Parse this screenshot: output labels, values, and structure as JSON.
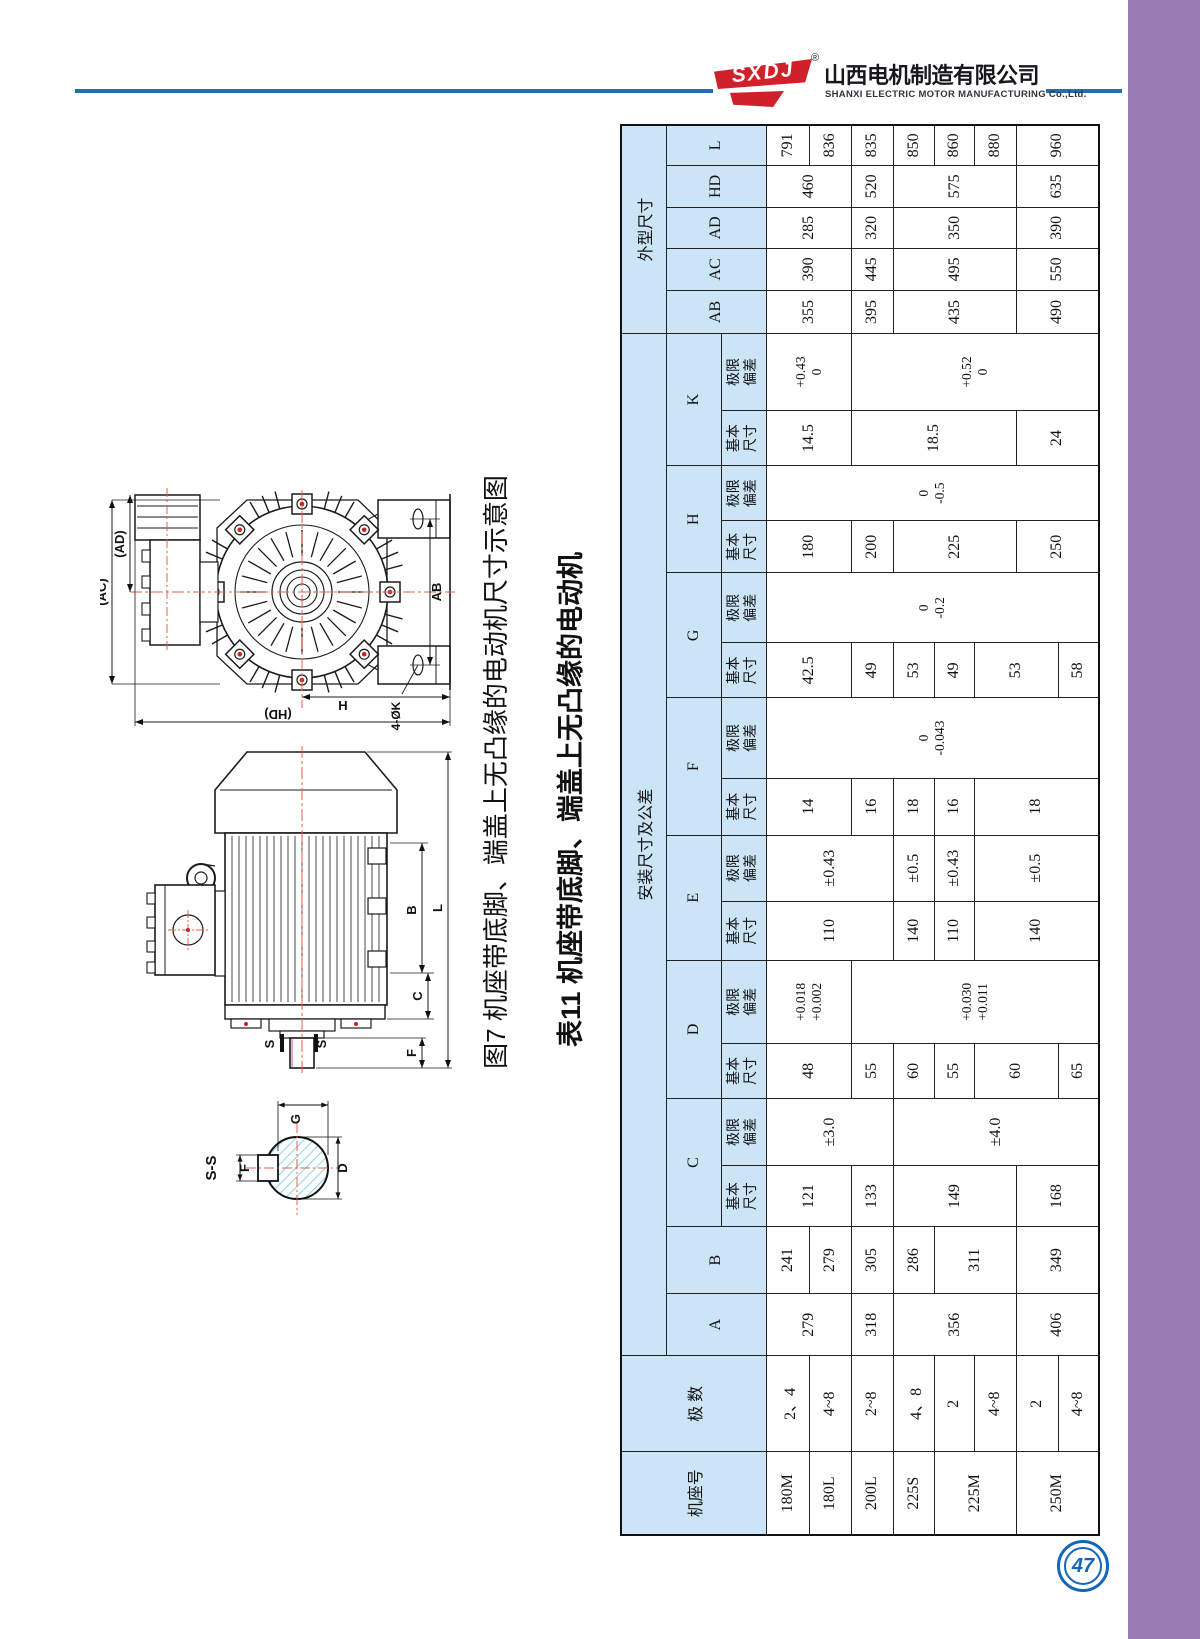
{
  "page": {
    "number": "47"
  },
  "header": {
    "logo_text": "SXDJ",
    "reg_mark": "®",
    "company_cn": "山西电机制造有限公司",
    "company_en": "SHANXI ELECTRIC MOTOR MANUFACTURING Co.,Ltd."
  },
  "figure": {
    "caption": "图7 机座带底脚、端盖上无凸缘的电动机尺寸示意图",
    "end_view_labels": {
      "ac": "(AC)",
      "ad": "(AD)",
      "ab": "AB",
      "h": "H",
      "hd": "(HD)",
      "k4": "4-ØK"
    },
    "side_view_labels": {
      "b": "B",
      "l": "L",
      "c": "C",
      "f": "F",
      "s1": "S",
      "s2": "S"
    },
    "section_labels": {
      "title": "S-S",
      "f": "F",
      "g": "G",
      "d": "D"
    }
  },
  "table": {
    "caption": "表11 机座带底脚、端盖上无凸缘的电动机",
    "cells": [
      [
        0,
        0,
        3,
        1,
        "机座号",
        1
      ],
      [
        0,
        1,
        3,
        1,
        "极 数",
        1
      ],
      [
        0,
        2,
        1,
        16,
        "安装尺寸及公差",
        1
      ],
      [
        0,
        18,
        1,
        5,
        "外型尺寸",
        1
      ],
      [
        1,
        2,
        2,
        1,
        "A",
        1
      ],
      [
        1,
        3,
        2,
        1,
        "B",
        1
      ],
      [
        1,
        4,
        1,
        2,
        "C",
        1
      ],
      [
        1,
        6,
        1,
        2,
        "D",
        1
      ],
      [
        1,
        8,
        1,
        2,
        "E",
        1
      ],
      [
        1,
        10,
        1,
        2,
        "F",
        1
      ],
      [
        1,
        12,
        1,
        2,
        "G",
        1
      ],
      [
        1,
        14,
        1,
        2,
        "H",
        1
      ],
      [
        1,
        16,
        1,
        2,
        "K",
        1
      ],
      [
        1,
        18,
        2,
        1,
        "AB",
        1
      ],
      [
        1,
        19,
        2,
        1,
        "AC",
        1
      ],
      [
        1,
        20,
        2,
        1,
        "AD",
        1
      ],
      [
        1,
        21,
        2,
        1,
        "HD",
        1
      ],
      [
        1,
        22,
        2,
        1,
        "L",
        1
      ],
      [
        2,
        4,
        1,
        1,
        "基本\n尺寸",
        1
      ],
      [
        2,
        5,
        1,
        1,
        "极限\n偏差",
        1
      ],
      [
        2,
        6,
        1,
        1,
        "基本\n尺寸",
        1
      ],
      [
        2,
        7,
        1,
        1,
        "极限\n偏差",
        1
      ],
      [
        2,
        8,
        1,
        1,
        "基本\n尺寸",
        1
      ],
      [
        2,
        9,
        1,
        1,
        "极限\n偏差",
        1
      ],
      [
        2,
        10,
        1,
        1,
        "基本\n尺寸",
        1
      ],
      [
        2,
        11,
        1,
        1,
        "极限\n偏差",
        1
      ],
      [
        2,
        12,
        1,
        1,
        "基本\n尺寸",
        1
      ],
      [
        2,
        13,
        1,
        1,
        "极限\n偏差",
        1
      ],
      [
        2,
        14,
        1,
        1,
        "基本\n尺寸",
        1
      ],
      [
        2,
        15,
        1,
        1,
        "极限\n偏差",
        1
      ],
      [
        2,
        16,
        1,
        1,
        "基本\n尺寸",
        1
      ],
      [
        2,
        17,
        1,
        1,
        "极限\n偏差",
        1
      ],
      [
        3,
        0,
        1,
        1,
        "180M",
        0
      ],
      [
        3,
        1,
        1,
        1,
        "2、4",
        0
      ],
      [
        3,
        2,
        2,
        1,
        "279",
        0
      ],
      [
        3,
        3,
        1,
        1,
        "241",
        0
      ],
      [
        3,
        4,
        2,
        1,
        "121",
        0
      ],
      [
        3,
        5,
        3,
        1,
        "±3.0",
        0
      ],
      [
        3,
        6,
        2,
        1,
        "48",
        0
      ],
      [
        3,
        7,
        2,
        1,
        "+0.018\n+0.002",
        0
      ],
      [
        3,
        8,
        3,
        1,
        "110",
        0
      ],
      [
        3,
        9,
        3,
        1,
        "±0.43",
        0
      ],
      [
        3,
        10,
        2,
        1,
        "14",
        0
      ],
      [
        3,
        11,
        8,
        1,
        "0\n-0.043",
        0
      ],
      [
        3,
        12,
        2,
        1,
        "42.5",
        0
      ],
      [
        3,
        13,
        8,
        1,
        "0\n-0.2",
        0
      ],
      [
        3,
        14,
        2,
        1,
        "180",
        0
      ],
      [
        3,
        15,
        8,
        1,
        "0\n-0.5",
        0
      ],
      [
        3,
        16,
        2,
        1,
        "14.5",
        0
      ],
      [
        3,
        17,
        2,
        1,
        "+0.43\n0",
        0
      ],
      [
        3,
        18,
        2,
        1,
        "355",
        0
      ],
      [
        3,
        19,
        2,
        1,
        "390",
        0
      ],
      [
        3,
        20,
        2,
        1,
        "285",
        0
      ],
      [
        3,
        21,
        2,
        1,
        "460",
        0
      ],
      [
        3,
        22,
        1,
        1,
        "791",
        0
      ],
      [
        4,
        0,
        1,
        1,
        "180L",
        0
      ],
      [
        4,
        1,
        1,
        1,
        "4~8",
        0
      ],
      [
        4,
        3,
        1,
        1,
        "279",
        0
      ],
      [
        4,
        22,
        1,
        1,
        "836",
        0
      ],
      [
        5,
        0,
        1,
        1,
        "200L",
        0
      ],
      [
        5,
        1,
        1,
        1,
        "2~8",
        0
      ],
      [
        5,
        2,
        1,
        1,
        "318",
        0
      ],
      [
        5,
        3,
        1,
        1,
        "305",
        0
      ],
      [
        5,
        4,
        1,
        1,
        "133",
        0
      ],
      [
        5,
        6,
        1,
        1,
        "55",
        0
      ],
      [
        5,
        7,
        6,
        1,
        "+0.030\n+0.011",
        0
      ],
      [
        5,
        10,
        1,
        1,
        "16",
        0
      ],
      [
        5,
        12,
        1,
        1,
        "49",
        0
      ],
      [
        5,
        14,
        1,
        1,
        "200",
        0
      ],
      [
        5,
        16,
        4,
        1,
        "18.5",
        0
      ],
      [
        5,
        17,
        6,
        1,
        "+0.52\n0",
        0
      ],
      [
        5,
        18,
        1,
        1,
        "395",
        0
      ],
      [
        5,
        19,
        1,
        1,
        "445",
        0
      ],
      [
        5,
        20,
        1,
        1,
        "320",
        0
      ],
      [
        5,
        21,
        1,
        1,
        "520",
        0
      ],
      [
        5,
        22,
        1,
        1,
        "835",
        0
      ],
      [
        6,
        0,
        1,
        1,
        "225S",
        0
      ],
      [
        6,
        1,
        1,
        1,
        "4、8",
        0
      ],
      [
        6,
        2,
        3,
        1,
        "356",
        0
      ],
      [
        6,
        3,
        1,
        1,
        "286",
        0
      ],
      [
        6,
        4,
        3,
        1,
        "149",
        0
      ],
      [
        6,
        5,
        5,
        1,
        "±4.0",
        0
      ],
      [
        6,
        6,
        1,
        1,
        "60",
        0
      ],
      [
        6,
        8,
        1,
        1,
        "140",
        0
      ],
      [
        6,
        9,
        1,
        1,
        "±0.5",
        0
      ],
      [
        6,
        10,
        1,
        1,
        "18",
        0
      ],
      [
        6,
        12,
        1,
        1,
        "53",
        0
      ],
      [
        6,
        14,
        3,
        1,
        "225",
        0
      ],
      [
        6,
        18,
        3,
        1,
        "435",
        0
      ],
      [
        6,
        19,
        3,
        1,
        "495",
        0
      ],
      [
        6,
        20,
        3,
        1,
        "350",
        0
      ],
      [
        6,
        21,
        3,
        1,
        "575",
        0
      ],
      [
        6,
        22,
        1,
        1,
        "850",
        0
      ],
      [
        7,
        0,
        2,
        1,
        "225M",
        0
      ],
      [
        7,
        1,
        1,
        1,
        "2",
        0
      ],
      [
        7,
        3,
        2,
        1,
        "311",
        0
      ],
      [
        7,
        6,
        1,
        1,
        "55",
        0
      ],
      [
        7,
        8,
        1,
        1,
        "110",
        0
      ],
      [
        7,
        9,
        1,
        1,
        "±0.43",
        0
      ],
      [
        7,
        10,
        1,
        1,
        "16",
        0
      ],
      [
        7,
        12,
        1,
        1,
        "49",
        0
      ],
      [
        7,
        22,
        1,
        1,
        "860",
        0
      ],
      [
        8,
        1,
        1,
        1,
        "4~8",
        0
      ],
      [
        8,
        6,
        2,
        1,
        "60",
        0
      ],
      [
        8,
        8,
        3,
        1,
        "140",
        0
      ],
      [
        8,
        9,
        3,
        1,
        "±0.5",
        0
      ],
      [
        8,
        10,
        3,
        1,
        "18",
        0
      ],
      [
        8,
        12,
        2,
        1,
        "53",
        0
      ],
      [
        8,
        22,
        1,
        1,
        "880",
        0
      ],
      [
        9,
        0,
        2,
        1,
        "250M",
        0
      ],
      [
        9,
        1,
        1,
        1,
        "2",
        0
      ],
      [
        9,
        2,
        2,
        1,
        "406",
        0
      ],
      [
        9,
        3,
        2,
        1,
        "349",
        0
      ],
      [
        9,
        4,
        2,
        1,
        "168",
        0
      ],
      [
        9,
        14,
        2,
        1,
        "250",
        0
      ],
      [
        9,
        16,
        2,
        1,
        "24",
        0
      ],
      [
        9,
        18,
        2,
        1,
        "490",
        0
      ],
      [
        9,
        19,
        2,
        1,
        "550",
        0
      ],
      [
        9,
        20,
        2,
        1,
        "390",
        0
      ],
      [
        9,
        21,
        2,
        1,
        "635",
        0
      ],
      [
        9,
        22,
        2,
        1,
        "960",
        0
      ],
      [
        10,
        1,
        1,
        1,
        "4~8",
        0
      ],
      [
        10,
        6,
        1,
        1,
        "65",
        0
      ],
      [
        10,
        12,
        1,
        1,
        "58",
        0
      ]
    ]
  },
  "colors": {
    "purple_band": "#9a7cb5",
    "blue_line": "#1d70b7",
    "logo_red": "#d0202a",
    "table_header_bg": "#cbe5f6",
    "page_number_blue": "#1566b8",
    "hatch_cyan": "#6ecbe0",
    "centerline_red": "#e0604a"
  }
}
